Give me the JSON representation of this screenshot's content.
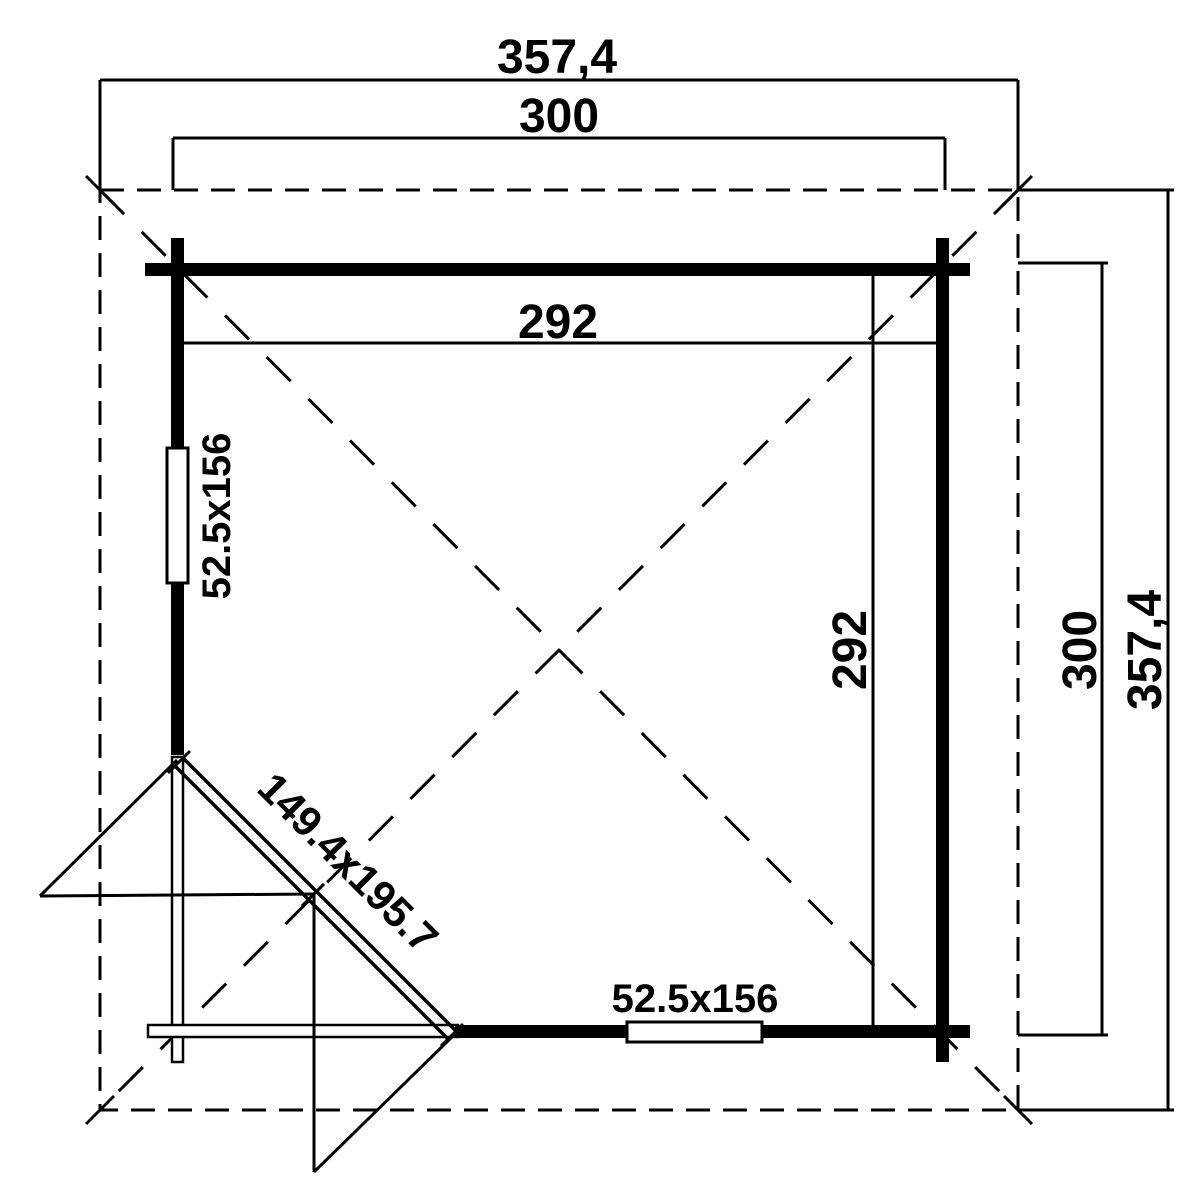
{
  "drawing": {
    "type": "log-cabin floor plan, corner entrance",
    "labels": {
      "roof_width_top": "357,4",
      "outer_width_top": "300",
      "inner_width": "292",
      "left_window": "52.5x156",
      "corner_door": "149.4x195.7",
      "bottom_window": "52.5x156",
      "inner_depth": "292",
      "outer_depth_right": "300",
      "roof_depth_right": "357,4"
    },
    "dimensions_cm": {
      "roof_overhang_square": 357.4,
      "outer_wall_square": 300,
      "inner_room_square": 292,
      "window_size": "52.5x156",
      "door_size": "149.4x195.7"
    }
  }
}
